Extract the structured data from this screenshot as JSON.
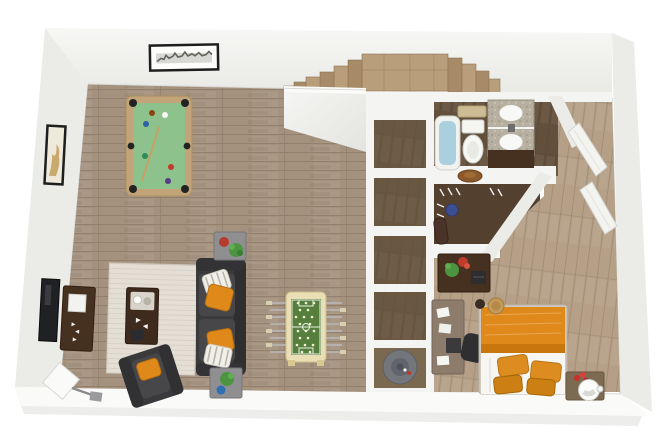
{
  "scene": {
    "type": "3d-floorplan-render",
    "view": "top-down-perspective",
    "rooms": [
      {
        "name": "game-living-room",
        "items": [
          "pool-table",
          "cue-stick",
          "billiard-balls",
          "framed-cityscape-art",
          "framed-abstract-art",
          "tv",
          "media-console",
          "area-rug",
          "coffee-table",
          "sofa",
          "armchair",
          "side-table-north",
          "side-table-south",
          "floor-lamp",
          "foosball-table",
          "plants"
        ]
      },
      {
        "name": "staircase",
        "items": [
          "curved-wood-steps",
          "landing"
        ]
      },
      {
        "name": "storage-divider",
        "items": [
          "open-shelving-cubbies",
          "utility-compartment",
          "water-heater"
        ]
      },
      {
        "name": "bathroom",
        "items": [
          "bathtub",
          "toilet",
          "towel-rack",
          "vanity",
          "double-sink",
          "mirror",
          "granite-counter"
        ]
      },
      {
        "name": "walk-in-closet",
        "items": [
          "shelf",
          "hat",
          "clothes-hangers",
          "blue-vase",
          "duffel-bag"
        ]
      },
      {
        "name": "hallway",
        "items": [
          "open-door",
          "open-door"
        ]
      },
      {
        "name": "bedroom",
        "items": [
          "bed",
          "orange-duvet",
          "orange-pillows",
          "storage-basket",
          "nightstand",
          "round-tray",
          "red-flowers",
          "desk-upper",
          "desk-lower",
          "office-chair",
          "laptop",
          "papers",
          "potted-plants"
        ]
      }
    ]
  },
  "colors": {
    "pageBg": "#ffffff",
    "wallTop": "#f4f4f2",
    "wallFace": "#ebebe8",
    "wallShadow": "#dddddA",
    "wallBright": "#fafaf8",
    "floorLiving": "#a5927e",
    "floorBedroom": "#b5a087",
    "floorCloset": "#54402e",
    "floorBath": "#63503c",
    "stairWood": "#b99e7b",
    "stairWoodDark": "#a78b68",
    "poolFelt": "#8ec28c",
    "poolRail": "#c2a478",
    "foosBody": "#eadfb4",
    "foosField": "#567f3e",
    "sofaDark": "#3a3a3d",
    "cushion": "#47474a",
    "accentOrange": "#e0891b",
    "orangeDeep": "#c8770f",
    "rugCream": "#e4dfd5",
    "woodDark": "#46301f",
    "deskGray": "#8d7b6b",
    "tableGray": "#8f8f91",
    "plantGreen": "#4c9440",
    "plantRed": "#c03a2b",
    "waterBlue": "#aacfdf",
    "granite": "#b7b0a0",
    "heaterGray": "#73767a",
    "bedWhite": "#f7f6f3",
    "frameBlack": "#1e1e1e",
    "tvBlack": "#202124",
    "doorWhite": "#f3f3f0",
    "basketTan": "#c49a58",
    "vaseBlue": "#3d4f92"
  }
}
